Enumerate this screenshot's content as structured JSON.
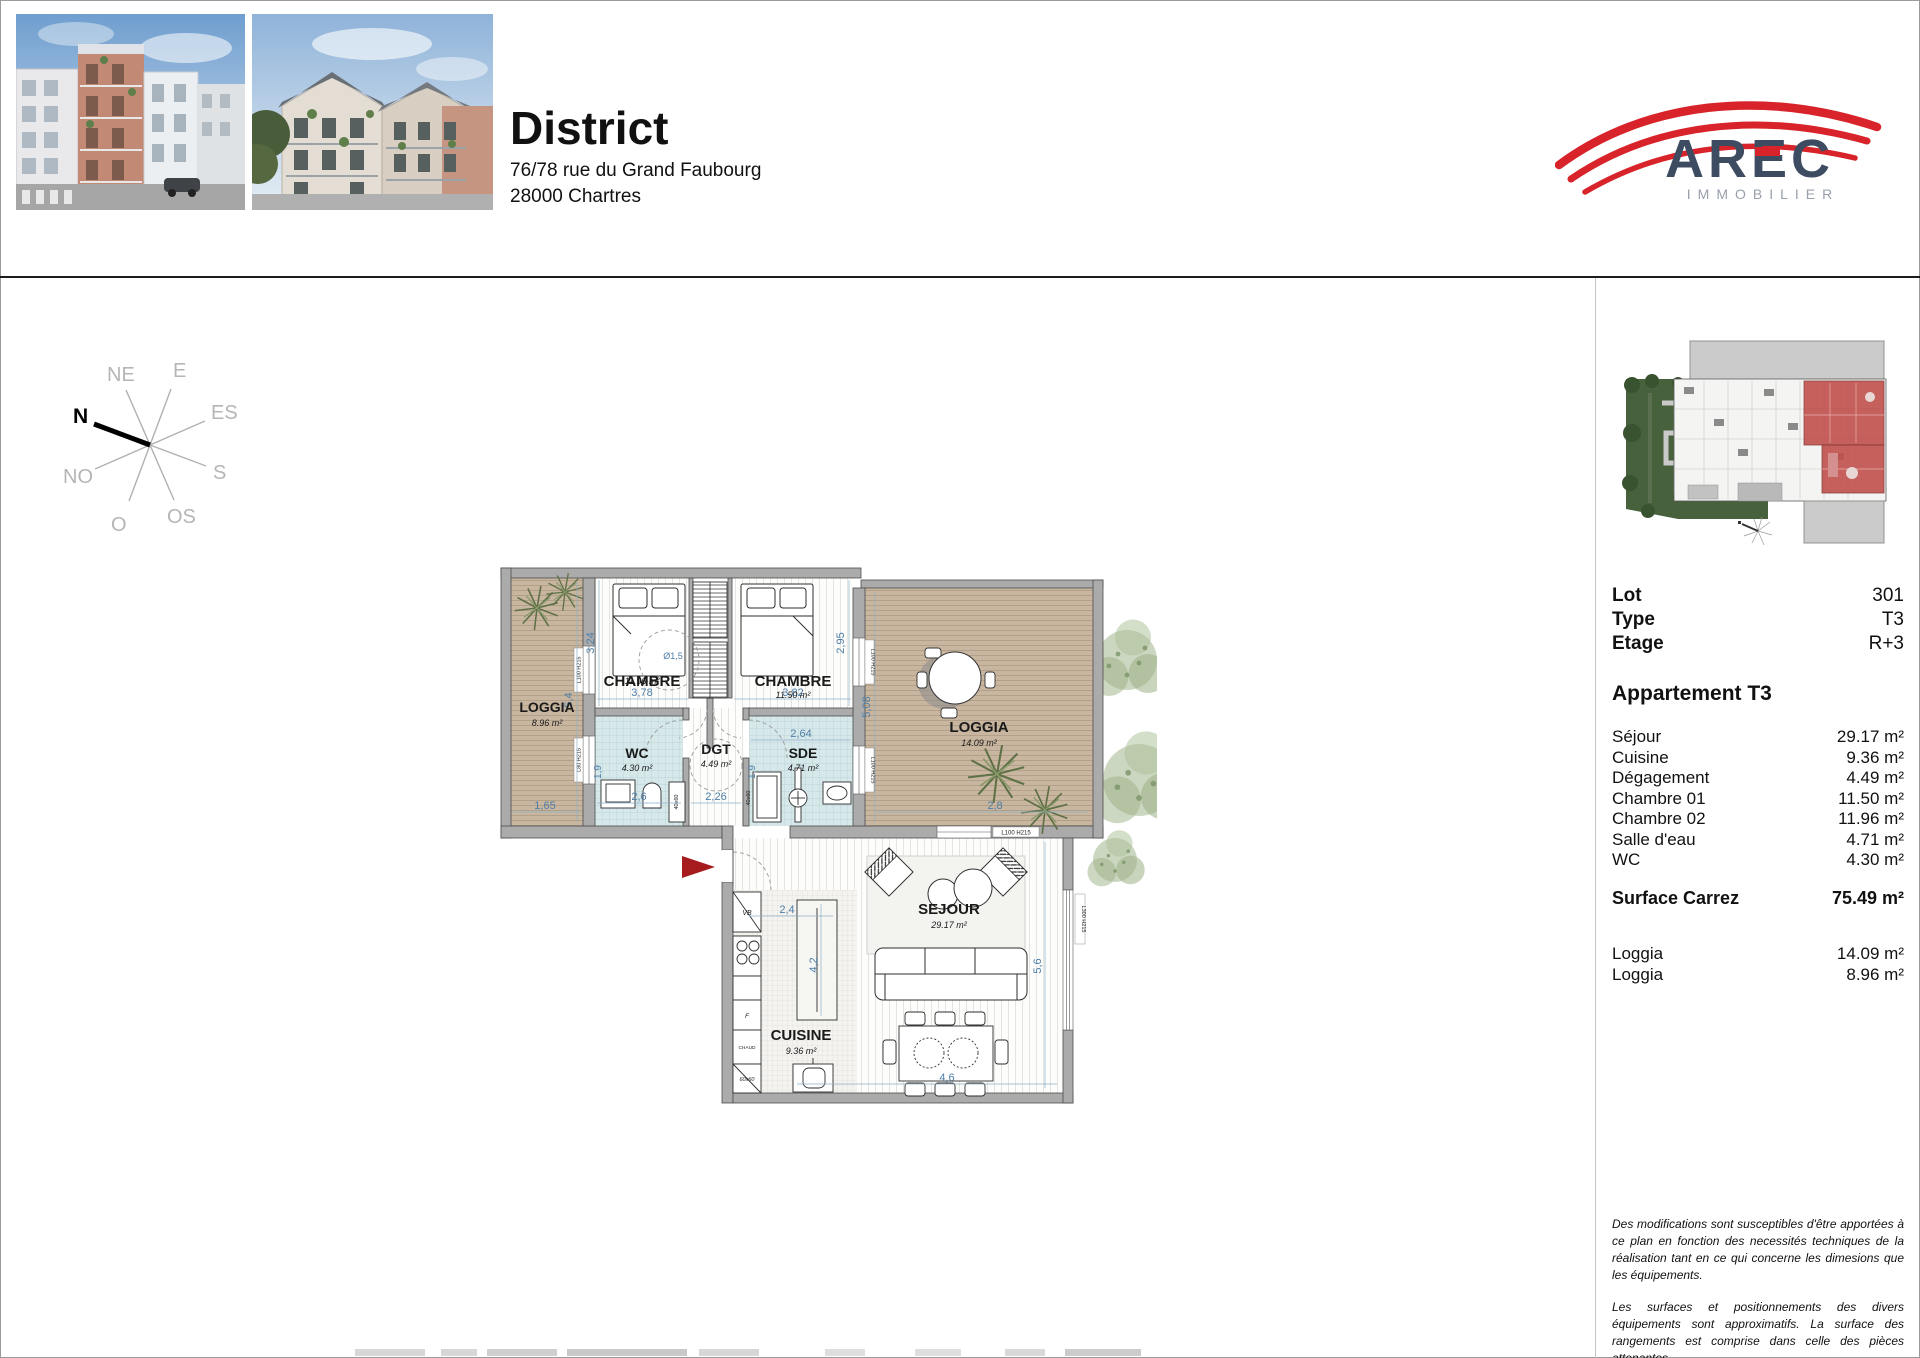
{
  "header": {
    "title": "District",
    "address_line1": "76/78 rue du Grand Faubourg",
    "address_line2": "28000 Chartres",
    "logo": {
      "name": "AREC",
      "subtitle": "IMMOBILIER"
    }
  },
  "compass": {
    "n": "N",
    "ne": "NE",
    "e": "E",
    "es": "ES",
    "s": "S",
    "os": "OS",
    "o": "O",
    "no": "NO"
  },
  "sidebar": {
    "lot": {
      "label": "Lot",
      "value": "301"
    },
    "type": {
      "label": "Type",
      "value": "T3"
    },
    "etage": {
      "label": "Etage",
      "value": "R+3"
    },
    "apartment_title": "Appartement T3",
    "rooms": [
      {
        "label": "Séjour",
        "value": "29.17 m²"
      },
      {
        "label": "Cuisine",
        "value": "9.36 m²"
      },
      {
        "label": "Dégagement",
        "value": "4.49 m²"
      },
      {
        "label": "Chambre 01",
        "value": "11.50 m²"
      },
      {
        "label": "Chambre 02",
        "value": "11.96 m²"
      },
      {
        "label": "Salle d'eau",
        "value": "4.71 m²"
      },
      {
        "label": "WC",
        "value": "4.30 m²"
      }
    ],
    "surface": {
      "label": "Surface Carrez",
      "value": "75.49 m²"
    },
    "loggias": [
      {
        "label": "Loggia",
        "value": "14.09 m²"
      },
      {
        "label": "Loggia",
        "value": "8.96 m²"
      }
    ],
    "disclaimer1": "Des modifications sont susceptibles d'être apportées à ce plan en fonction des necessités techniques de la réalisation tant en ce qui concerne les dimesions que les équipements.",
    "disclaimer2": "Les surfaces et positionnements des divers équipements sont approximatifs. La surface des rangements est comprise dans celle des pièces attenantes."
  },
  "plan": {
    "rooms": [
      {
        "name": "LOGGIA",
        "area": "8.96 m²"
      },
      {
        "name": "CHAMBRE",
        "area": "11.96 m²"
      },
      {
        "name": "CHAMBRE",
        "area": "11.50 m²"
      },
      {
        "name": "WC",
        "area": "4.30 m²"
      },
      {
        "name": "DGT",
        "area": "4.49 m²"
      },
      {
        "name": "SDE",
        "area": "4.71 m²"
      },
      {
        "name": "LOGGIA",
        "area": "14.09 m²"
      },
      {
        "name": "SEJOUR",
        "area": "29.17 m²"
      },
      {
        "name": "CUISINE",
        "area": "9.36 m²"
      }
    ],
    "dims": {
      "chambre2_side": "3,24",
      "chambre2_width": "3,78",
      "turning_circle": "Ø1,5",
      "loggia_left_height": "5,4",
      "loggia_left_width": "1,65",
      "wc_height": "1,9",
      "wc_width": "2,6",
      "dgt_width": "2,26",
      "sde_width": "2,64",
      "sde_height": "1,9",
      "chambre1_width": "3,82",
      "chambre1_side": "2,95",
      "loggia_right_height": "5,08",
      "loggia_right_width": "2,8",
      "cuisine_width": "2,4",
      "cuisine_depth": "4,2",
      "sejour_height": "5,6",
      "sejour_width": "4,6"
    },
    "window_labels": {
      "left_top": "L100 H215",
      "left_bottom": "L80 H215",
      "right_top": "L100 H215",
      "right_bottom": "L100 H215",
      "sejour_top": "L100 H215",
      "sejour_side": "L300 H215"
    },
    "fixture_labels": {
      "vb": "VB",
      "fridge": "F",
      "chaud": "CHAUD",
      "sink": "60x60",
      "shower_wc": "40x60",
      "shower_sde": "40x60"
    }
  },
  "colors": {
    "accent_red": "#d8232a",
    "dim_blue": "#4d7ea8",
    "loggia_tan": "#c8b6a0",
    "wet_teal": "#d6e8ea",
    "wall_gray": "#ababab",
    "site_green": "#46613b",
    "site_red": "#c0504d"
  }
}
